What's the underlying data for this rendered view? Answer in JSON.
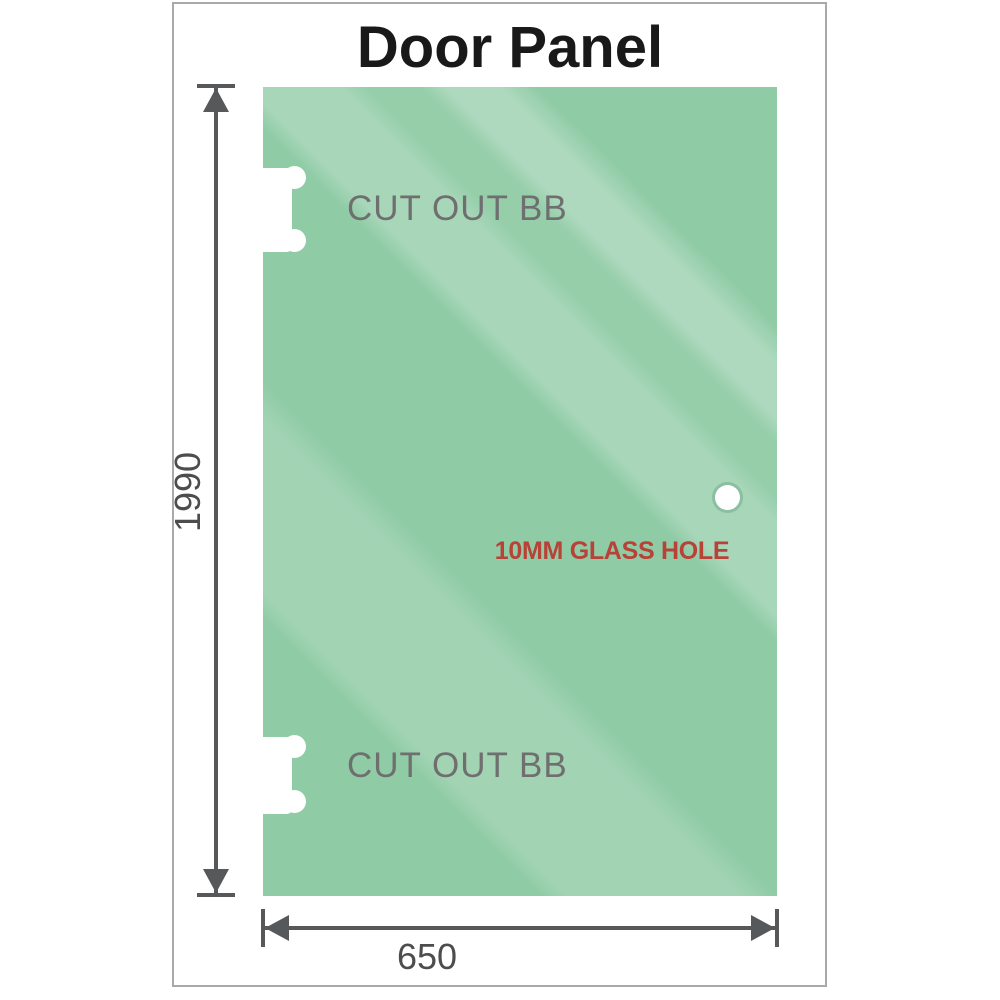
{
  "title": "Door Panel",
  "panel": {
    "cutouts": [
      {
        "label": "CUT OUT BB"
      },
      {
        "label": "CUT OUT BB"
      }
    ],
    "hole": {
      "label": "10MM GLASS HOLE"
    }
  },
  "dimensions": {
    "height": "1990",
    "width": "650"
  },
  "colors": {
    "glass_green": "#8fcba5",
    "glass_highlight": "#b9e0c7",
    "dimension_gray": "#57585a",
    "label_gray": "#6f6f6f",
    "hole_label_red": "#b84238",
    "frame_border": "#a9a9a9",
    "title_black": "#191919"
  },
  "icons": {
    "vertical_dimension": "double-headed-arrow-vertical",
    "horizontal_dimension": "double-headed-arrow-horizontal"
  }
}
